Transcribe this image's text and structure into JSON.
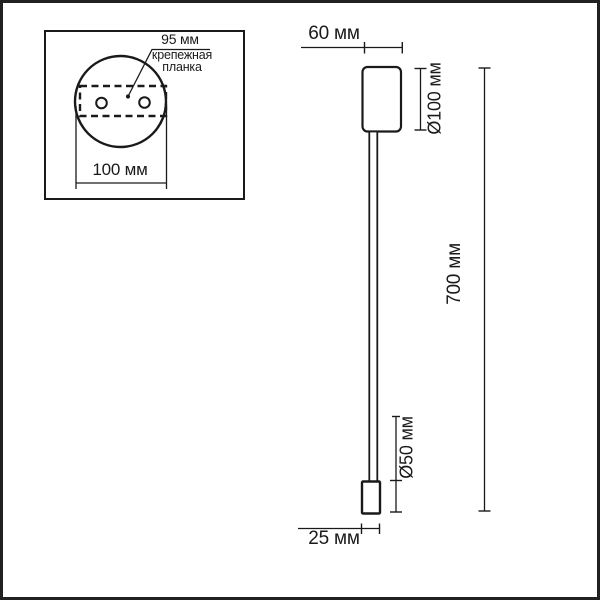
{
  "colors": {
    "ink": "#1a1a1a",
    "background": "#ffffff",
    "border": "#212121"
  },
  "inset": {
    "hole_spacing_label": "95 мм",
    "plate_label_line1": "крепежная",
    "plate_label_line2": "планка",
    "plate_width_label": "100 мм"
  },
  "lamp_dimensions": {
    "head_width_label": "60 мм",
    "head_diameter_label": "Ø100 мм",
    "overall_height_label": "700 мм",
    "tip_diameter_label": "Ø50 мм",
    "tip_width_label": "25 мм"
  }
}
